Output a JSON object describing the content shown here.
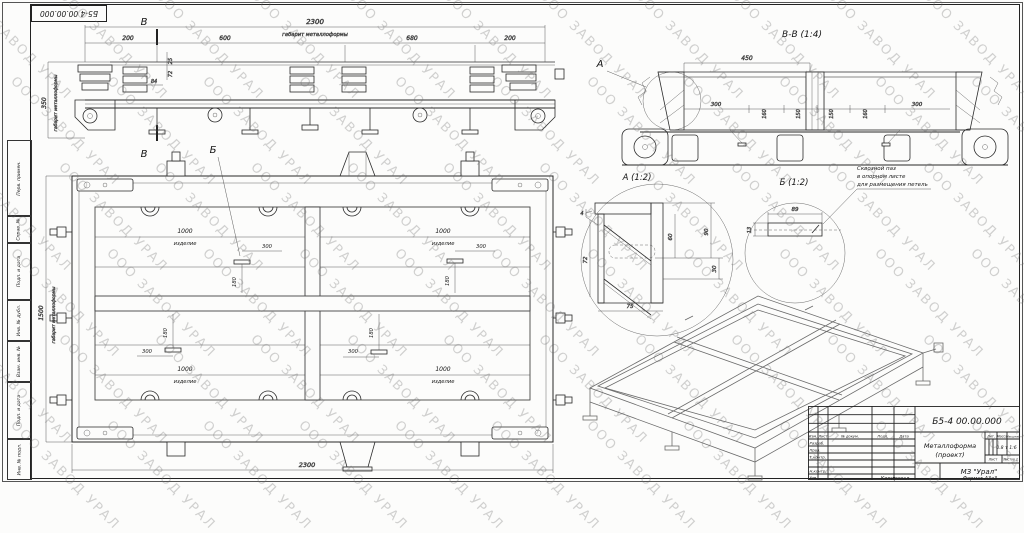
{
  "watermark": {
    "text": "ООО ЗАВОД УРАЛ"
  },
  "frame": {
    "doc_number": "Б5-4 00.00.000",
    "side_labels": [
      "Перв. примен.",
      "Справ. №",
      "Подп. и дата",
      "Инв. № дубл.",
      "Взам. инв. №",
      "Подп. и дата",
      "Инв. № подл."
    ]
  },
  "front": {
    "section_mark": "В",
    "dim_overall": "2300",
    "dim_overall_note": "габарит металлоформы",
    "dim_200l": "200",
    "dim_600": "600",
    "dim_680": "680",
    "dim_200r": "200",
    "dim_height": "350",
    "dim_height_note": "габарит металлоформы",
    "dim_s1": "25",
    "dim_s2": "72",
    "dim_s3": "84"
  },
  "plan": {
    "callout": "Б",
    "dim_width": "2300",
    "dim_height": "1500",
    "dim_height_note": "габарит металлоформы",
    "cell_dim": "1000",
    "cell_label": "изделие",
    "slot_dim_x": "300",
    "slot_dim_y": "180"
  },
  "section_bb": {
    "title": "В-В (1:4)",
    "callout": "А",
    "dim_450": "450",
    "dim_300": "300",
    "dim_160": "160",
    "dim_150": "150"
  },
  "detail_a": {
    "title": "А (1:2)",
    "dim_72": "72",
    "dim_60": "60",
    "dim_90": "90",
    "dim_30": "30",
    "dim_75": "75",
    "weld": "4"
  },
  "detail_b": {
    "title": "Б (1:2)",
    "dim_89": "89",
    "dim_13": "13",
    "note1": "Сквозной паз",
    "note2": "в опорном листе",
    "note3": "для размещения петель"
  },
  "title_block": {
    "designation": "Б5-4 00.00.000",
    "name_line1": "Металлоформа",
    "name_line2": "(проект)",
    "org": "МЗ \"Урал\"",
    "col_izm": "Изм.",
    "col_list": "Лист",
    "col_doc": "№ докум.",
    "col_podp": "Подп.",
    "col_data": "Дата",
    "row_razrab": "Разраб.",
    "row_prov": "Пров.",
    "row_tkontr": "Т.контр.",
    "row_nkontr": "Н.контр.",
    "row_utv": "Утв.",
    "lit_label": "Лит.",
    "mass_label": "Масса",
    "scale_label": "Масштаб",
    "mass_value": "0.8 т",
    "scale_value": "1:6",
    "sheet_label": "Лист",
    "sheets_label": "Листов",
    "sheets_value": "1",
    "footer_copy": "Копировал",
    "footer_format": "Формат А3х3"
  }
}
